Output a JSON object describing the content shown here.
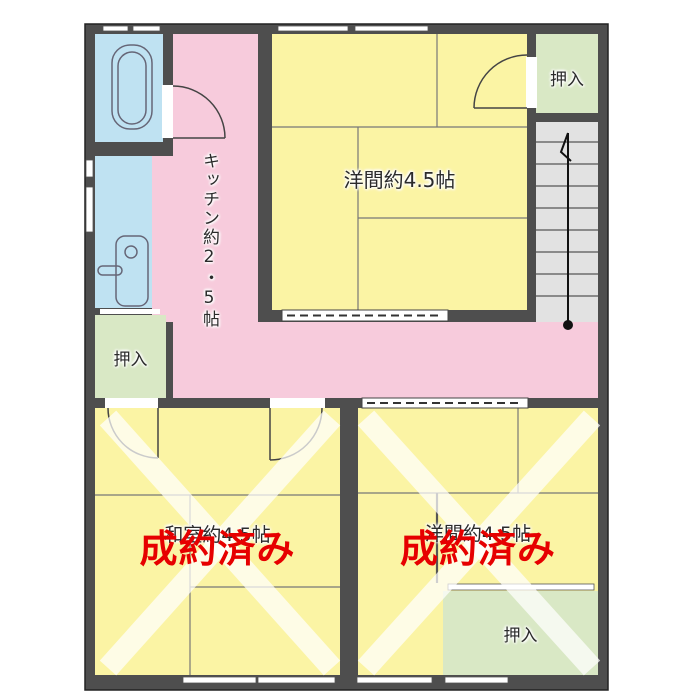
{
  "rooms": {
    "kitchen": {
      "label": "キッチン約2・5帖"
    },
    "western_room": {
      "label": "洋間約4.5帖"
    },
    "closet_top_right": {
      "label": "押入"
    },
    "closet_left": {
      "label": "押入"
    },
    "closet_bottom_right": {
      "label": "押入"
    },
    "bottom_left_room": {
      "label": "和室約4.5帖",
      "status": "成約済み"
    },
    "bottom_right_room": {
      "label": "洋間約4.5帖",
      "status": "成約済み"
    }
  },
  "colors": {
    "wall": "#4E4E4E",
    "kitchen_pink": "#F7CBDC",
    "room_yellow": "#FBF4A4",
    "closet_green": "#D9E8C5",
    "bath_blue": "#BFE2F2",
    "stairs_gray": "#E2E2E2",
    "sold_red": "#E60000",
    "x_mark_white": "rgba(255,255,255,0.72)"
  }
}
